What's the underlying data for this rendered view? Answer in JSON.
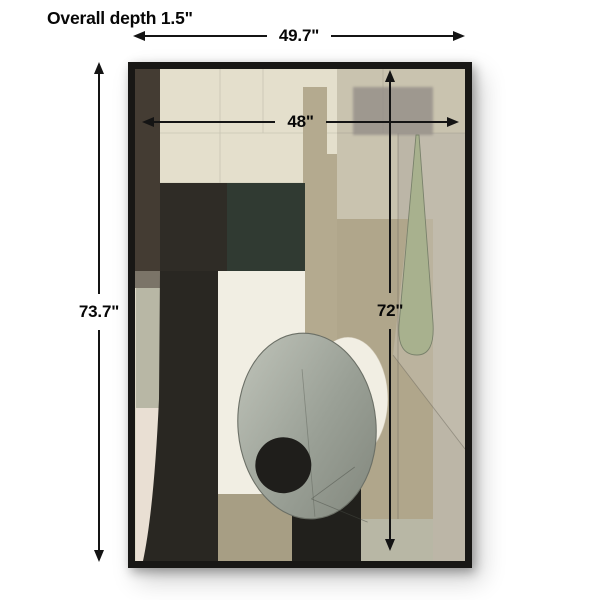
{
  "annotations": {
    "depth_label": "Overall depth 1.5\"",
    "overall_width": "49.7\"",
    "overall_height": "73.7\"",
    "canvas_width": "48\"",
    "canvas_height": "72\""
  },
  "artwork": {
    "kind": "framed abstract painting",
    "palette": {
      "frame": "#181715",
      "cream": "#ddd8c5",
      "cream_light": "#e4dfcc",
      "beige_top_right": "#c9c3af",
      "right_col": "#bcb6a7",
      "tan_mid": "#b0a68b",
      "pale_strip": "#b8b7a5",
      "wedge_light": "#c6c0b1",
      "gray_rect": "#97918a",
      "taupe": "#b4aa8f",
      "charcoal": "#2f2c26",
      "dark_green": "#303a32",
      "left_strip": "#443c33",
      "strip_gray": "#7b7468",
      "white_strip": "#e9dfd3",
      "white_panel": "#f1eee3",
      "black_col": "#292722",
      "taupe_bottom": "#a79e84",
      "black_deep": "#21201c",
      "sage": "#a8b18e",
      "sage_edge": "#79816b",
      "egg_light": "#bdc1b7",
      "egg_dark": "#868b81",
      "egg_edge": "#6b6f66",
      "ink": "#1f1e1b"
    }
  },
  "dimension_style": {
    "dim_line": "#141414",
    "dim_text": "#070707"
  }
}
